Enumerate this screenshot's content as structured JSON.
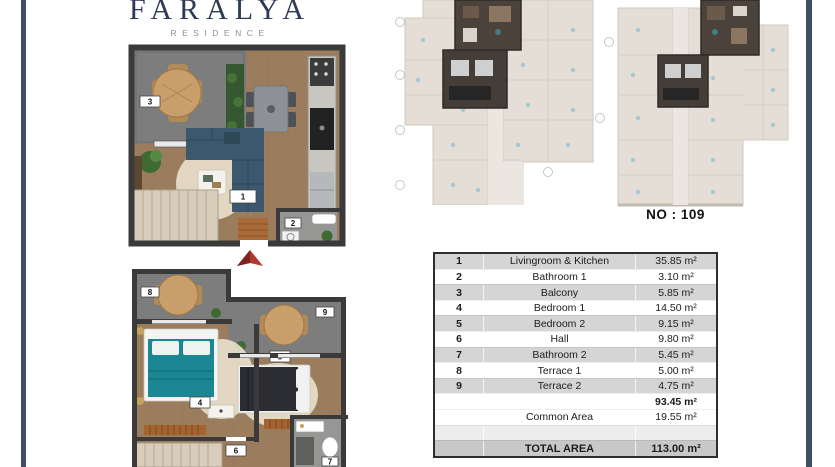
{
  "logo": {
    "title": "FARALYA",
    "subtitle": "RESIDENCE"
  },
  "unit": {
    "label": "NO : 109"
  },
  "plan_labels": {
    "living": "1",
    "bath1": "2",
    "balcony": "3",
    "bed1": "4",
    "bed2": "5",
    "hall": "6",
    "bath2": "7",
    "terrace1": "8",
    "terrace2": "9"
  },
  "area_table": {
    "rows": [
      {
        "no": "1",
        "name": "Livingroom & Kitchen",
        "area": "35.85 m²"
      },
      {
        "no": "2",
        "name": "Bathroom 1",
        "area": "3.10 m²"
      },
      {
        "no": "3",
        "name": "Balcony",
        "area": "5.85 m²"
      },
      {
        "no": "4",
        "name": "Bedroom 1",
        "area": "14.50 m²"
      },
      {
        "no": "5",
        "name": "Bedroom 2",
        "area": "9.15 m²"
      },
      {
        "no": "6",
        "name": "Hall",
        "area": "9.80 m²"
      },
      {
        "no": "7",
        "name": "Bathroom 2",
        "area": "5.45 m²"
      },
      {
        "no": "8",
        "name": "Terrace 1",
        "area": "5.00 m²"
      },
      {
        "no": "9",
        "name": "Terrace 2",
        "area": "4.75 m²"
      },
      {
        "no": "",
        "name": "",
        "area": "93.45 m²"
      },
      {
        "no": "",
        "name": "Common Area",
        "area": "19.55 m²"
      },
      {
        "no": "",
        "name": "",
        "area": ""
      },
      {
        "no": "",
        "name": "TOTAL AREA",
        "area": "113.00 m²"
      }
    ]
  },
  "colors": {
    "frame_navy": "#3e4e67",
    "logo_navy": "#2c3a55",
    "wood_floor": "#9b7d5e",
    "terrace_gray": "#7d7d7d",
    "sofa_navy": "#3b586e",
    "bed_teal": "#1b8794",
    "entry_arrow_red": "#b0392f",
    "table_row_gray": "#d5d5d5",
    "table_total_gray": "#c8c8c8",
    "table_border": "#2e2e2e"
  }
}
